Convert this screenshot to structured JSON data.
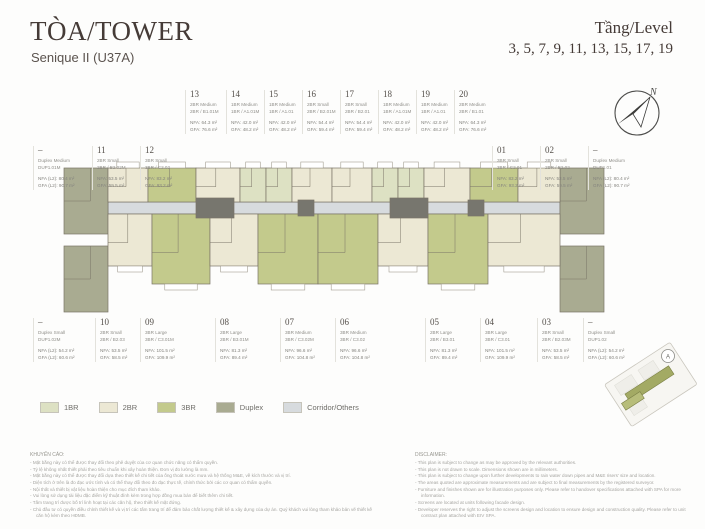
{
  "header": {
    "title": "TÒA/TOWER",
    "subtitle": "Senique II (U37A)",
    "level_label": "Tầng/Level",
    "levels": "3, 5, 7, 9, 11, 13, 15, 17, 19"
  },
  "units_top": [
    {
      "no": "13",
      "type": "2BR Medium",
      "code": "2BR / B1.01M",
      "nfa": "NFA: 64.3 m²",
      "gfa": "GFA: 76.6 m²"
    },
    {
      "no": "14",
      "type": "1BR Medium",
      "code": "1BR / A1.01M",
      "nfa": "NFA: 42.0 m²",
      "gfa": "GFA: 48.2 m²"
    },
    {
      "no": "15",
      "type": "1BR Medium",
      "code": "1BR / A1.01",
      "nfa": "NFA: 42.0 m²",
      "gfa": "GFA: 48.2 m²"
    },
    {
      "no": "16",
      "type": "2BR Small",
      "code": "2BR / B2.01M",
      "nfa": "NFA: 54.4 m²",
      "gfa": "GFA: 59.4 m²"
    },
    {
      "no": "17",
      "type": "2BR Small",
      "code": "2BR / B2.01",
      "nfa": "NFA: 54.4 m²",
      "gfa": "GFA: 59.4 m²"
    },
    {
      "no": "18",
      "type": "1BR Medium",
      "code": "1BR / A1.01M",
      "nfa": "NFA: 42.0 m²",
      "gfa": "GFA: 48.2 m²"
    },
    {
      "no": "19",
      "type": "1BR Medium",
      "code": "1BR / A1.01",
      "nfa": "NFA: 42.0 m²",
      "gfa": "GFA: 48.2 m²"
    },
    {
      "no": "20",
      "type": "2BR Medium",
      "code": "2BR / B1.01",
      "nfa": "NFA: 64.3 m²",
      "gfa": "GFA: 76.6 m²"
    }
  ],
  "units_left": [
    {
      "no": "–",
      "type": "Duplex Medium",
      "code": "DUP1.01M",
      "nfa": "NFA (L2): 80.4 m²",
      "gfa": "GFA (L2): 90.7 m²"
    },
    {
      "no": "11",
      "type": "2BR Small",
      "code": "2BR / B2.02M",
      "nfa": "NFA: 53.5 m²",
      "gfa": "GFA: 59.5 m²"
    },
    {
      "no": "12",
      "type": "3BR Small",
      "code": "3BR / C2.02",
      "nfa": "NFA: 83.2 m²",
      "gfa": "GFA: 93.2 m²"
    }
  ],
  "units_right": [
    {
      "no": "01",
      "type": "3BR Small",
      "code": "3BR / C2.01",
      "nfa": "NFA: 83.2 m²",
      "gfa": "GFA: 93.2 m²"
    },
    {
      "no": "02",
      "type": "2BR Small",
      "code": "2BR / B2.02",
      "nfa": "NFA: 53.5 m²",
      "gfa": "GFA: 59.5 m²"
    },
    {
      "no": "–",
      "type": "Duplex Medium",
      "code": "DUP1.01",
      "nfa": "NFA (L2): 80.4 m²",
      "gfa": "GFA (L2): 90.7 m²"
    }
  ],
  "units_bottom": [
    {
      "no": "–",
      "type": "Duplex Small",
      "code": "DUP1.02M",
      "nfa": "NFA (L2): 54.2 m²",
      "gfa": "GFA (L2): 60.6 m²"
    },
    {
      "no": "10",
      "type": "2BR Small",
      "code": "2BR / B2.03",
      "nfa": "NFA: 53.5 m²",
      "gfa": "GFA: 58.5 m²"
    },
    {
      "no": "09",
      "type": "3BR Large",
      "code": "3BR / C3.01M",
      "nfa": "NFA: 101.5 m²",
      "gfa": "GFA: 109.9 m²"
    },
    {
      "no": "08",
      "type": "2BR Large",
      "code": "2BR / B3.01M",
      "nfa": "NFA: 81.3 m²",
      "gfa": "GFA: 89.4 m²"
    },
    {
      "no": "07",
      "type": "3BR Medium",
      "code": "3BR / C3.02M",
      "nfa": "NFA: 96.6 m²",
      "gfa": "GFA: 104.8 m²"
    },
    {
      "no": "06",
      "type": "3BR Medium",
      "code": "3BR / C3.02",
      "nfa": "NFA: 96.6 m²",
      "gfa": "GFA: 104.8 m²"
    },
    {
      "no": "05",
      "type": "2BR Large",
      "code": "2BR / B3.01",
      "nfa": "NFA: 81.3 m²",
      "gfa": "GFA: 89.4 m²"
    },
    {
      "no": "04",
      "type": "3BR Large",
      "code": "3BR / C3.01",
      "nfa": "NFA: 101.5 m²",
      "gfa": "GFA: 109.9 m²"
    },
    {
      "no": "03",
      "type": "2BR Small",
      "code": "2BR / B2.03M",
      "nfa": "NFA: 53.5 m²",
      "gfa": "GFA: 58.5 m²"
    },
    {
      "no": "–",
      "type": "Duplex Small",
      "code": "DUP1.02",
      "nfa": "NFA (L2): 54.2 m²",
      "gfa": "GFA (L2): 60.6 m²"
    }
  ],
  "legend": [
    {
      "label": "1BR",
      "color": "#dde1c3"
    },
    {
      "label": "2BR",
      "color": "#ece8d4"
    },
    {
      "label": "3BR",
      "color": "#c3ca8c"
    },
    {
      "label": "Duplex",
      "color": "#a9ab91"
    },
    {
      "label": "Corridor/Others",
      "color": "#d7dbde"
    }
  ],
  "compass": {
    "north_label": "N"
  },
  "keyplan": {
    "marker": "A"
  },
  "advisory": {
    "title": "KHUYẾN CÁO:",
    "lines": [
      "Mặt bằng này có thể được thay đổi theo phê duyệt của cơ quan chức năng có thẩm quyền.",
      "Tỷ lệ không nhất thiết phải theo tiêu chuẩn khi xây hoàn thiện. Đơn vị đo lường là mm.",
      "Mặt bằng này có thể được thay đổi dựa theo thiết kế chi tiết của ống thoát nước mưa và hệ thống M&E, về kích thước và vị trí.",
      "Diện tích ở trên là đo đạc ước tính và có thể thay đổi theo đo đạc thực tế, chính thức bởi các cơ quan có thẩm quyền.",
      "Nội thất và thiết bị vật liệu hoàn thiện cho mục đích tham khảo.",
      "Vui lòng sử dụng tài liệu đặc điểm kỹ thuật đính kèm trong hợp đồng mua bán để biết thêm chi tiết.",
      "Tấm trang trí được bố trí linh hoạt tại các căn hộ, theo thiết kế mặt đứng.",
      "Chủ đầu tư có quyền điều chỉnh thiết kế và vị trí các tấm trang trí để đảm bảo chất lượng thiết kế & xây dựng của dự án. Quý khách vui lòng tham khảo bản vẽ thiết kế căn hộ kèm theo HĐMB."
    ]
  },
  "disclaimer": {
    "title": "DISCLAIMER:",
    "lines": [
      "This plan is subject to change as may be approved by the relevant authorities.",
      "This plan is not drawn to scale. Dimensions shown are in millimeters.",
      "This plan is subject to change upon further developments to rain water down pipes and M&E risers' size and location.",
      "The areas quoted are approximate measurements and are subject to final measurements by the registered surveyor.",
      "Furniture and finishes shown are for illustration purposes only. Please refer to handover specifications attached with SPA for more information.",
      "Screens are located at units following facade design.",
      "Developer reserves the right to adjust the screens design and location to ensure design and construction quality. Please refer to unit contract plan attached with EIV SPA."
    ]
  },
  "floorplan": {
    "wall_color": "#7a7467",
    "core_color": "#77766e",
    "corridor": {
      "x": 108,
      "y": 202,
      "w": 452,
      "h": 12
    },
    "blocks": [
      {
        "x": 64,
        "y": 168,
        "w": 44,
        "h": 66,
        "t": "Duplex"
      },
      {
        "x": 64,
        "y": 246,
        "w": 44,
        "h": 66,
        "t": "Duplex"
      },
      {
        "x": 560,
        "y": 168,
        "w": 44,
        "h": 66,
        "t": "Duplex"
      },
      {
        "x": 560,
        "y": 246,
        "w": 44,
        "h": 66,
        "t": "Duplex"
      },
      {
        "x": 108,
        "y": 168,
        "w": 40,
        "h": 34,
        "t": "2BR",
        "band": "top"
      },
      {
        "x": 148,
        "y": 168,
        "w": 48,
        "h": 34,
        "t": "3BR",
        "band": "top"
      },
      {
        "x": 196,
        "y": 168,
        "w": 44,
        "h": 34,
        "t": "2BR",
        "band": "top"
      },
      {
        "x": 240,
        "y": 168,
        "w": 26,
        "h": 34,
        "t": "1BR",
        "band": "top"
      },
      {
        "x": 266,
        "y": 168,
        "w": 26,
        "h": 34,
        "t": "1BR",
        "band": "top"
      },
      {
        "x": 292,
        "y": 168,
        "w": 40,
        "h": 34,
        "t": "2BR",
        "band": "top"
      },
      {
        "x": 332,
        "y": 168,
        "w": 40,
        "h": 34,
        "t": "2BR",
        "band": "top"
      },
      {
        "x": 372,
        "y": 168,
        "w": 26,
        "h": 34,
        "t": "1BR",
        "band": "top"
      },
      {
        "x": 398,
        "y": 168,
        "w": 26,
        "h": 34,
        "t": "1BR",
        "band": "top"
      },
      {
        "x": 424,
        "y": 168,
        "w": 46,
        "h": 34,
        "t": "2BR",
        "band": "top"
      },
      {
        "x": 470,
        "y": 168,
        "w": 48,
        "h": 34,
        "t": "3BR",
        "band": "top"
      },
      {
        "x": 518,
        "y": 168,
        "w": 42,
        "h": 34,
        "t": "2BR",
        "band": "top"
      },
      {
        "x": 108,
        "y": 214,
        "w": 44,
        "h": 52,
        "t": "2BR",
        "band": "bottom"
      },
      {
        "x": 152,
        "y": 214,
        "w": 58,
        "h": 70,
        "t": "3BR",
        "band": "bottom"
      },
      {
        "x": 210,
        "y": 214,
        "w": 48,
        "h": 52,
        "t": "2BR",
        "band": "bottom"
      },
      {
        "x": 258,
        "y": 214,
        "w": 60,
        "h": 70,
        "t": "3BR",
        "band": "bottom"
      },
      {
        "x": 318,
        "y": 214,
        "w": 60,
        "h": 70,
        "t": "3BR",
        "band": "bottom"
      },
      {
        "x": 378,
        "y": 214,
        "w": 50,
        "h": 52,
        "t": "2BR",
        "band": "bottom"
      },
      {
        "x": 428,
        "y": 214,
        "w": 60,
        "h": 70,
        "t": "3BR",
        "band": "bottom"
      },
      {
        "x": 488,
        "y": 214,
        "w": 72,
        "h": 52,
        "t": "2BR",
        "band": "bottom"
      },
      {
        "x": 196,
        "y": 198,
        "w": 38,
        "h": 20,
        "t": "Core"
      },
      {
        "x": 298,
        "y": 200,
        "w": 16,
        "h": 16,
        "t": "Core"
      },
      {
        "x": 390,
        "y": 198,
        "w": 38,
        "h": 20,
        "t": "Core"
      },
      {
        "x": 468,
        "y": 200,
        "w": 16,
        "h": 16,
        "t": "Core"
      }
    ]
  }
}
